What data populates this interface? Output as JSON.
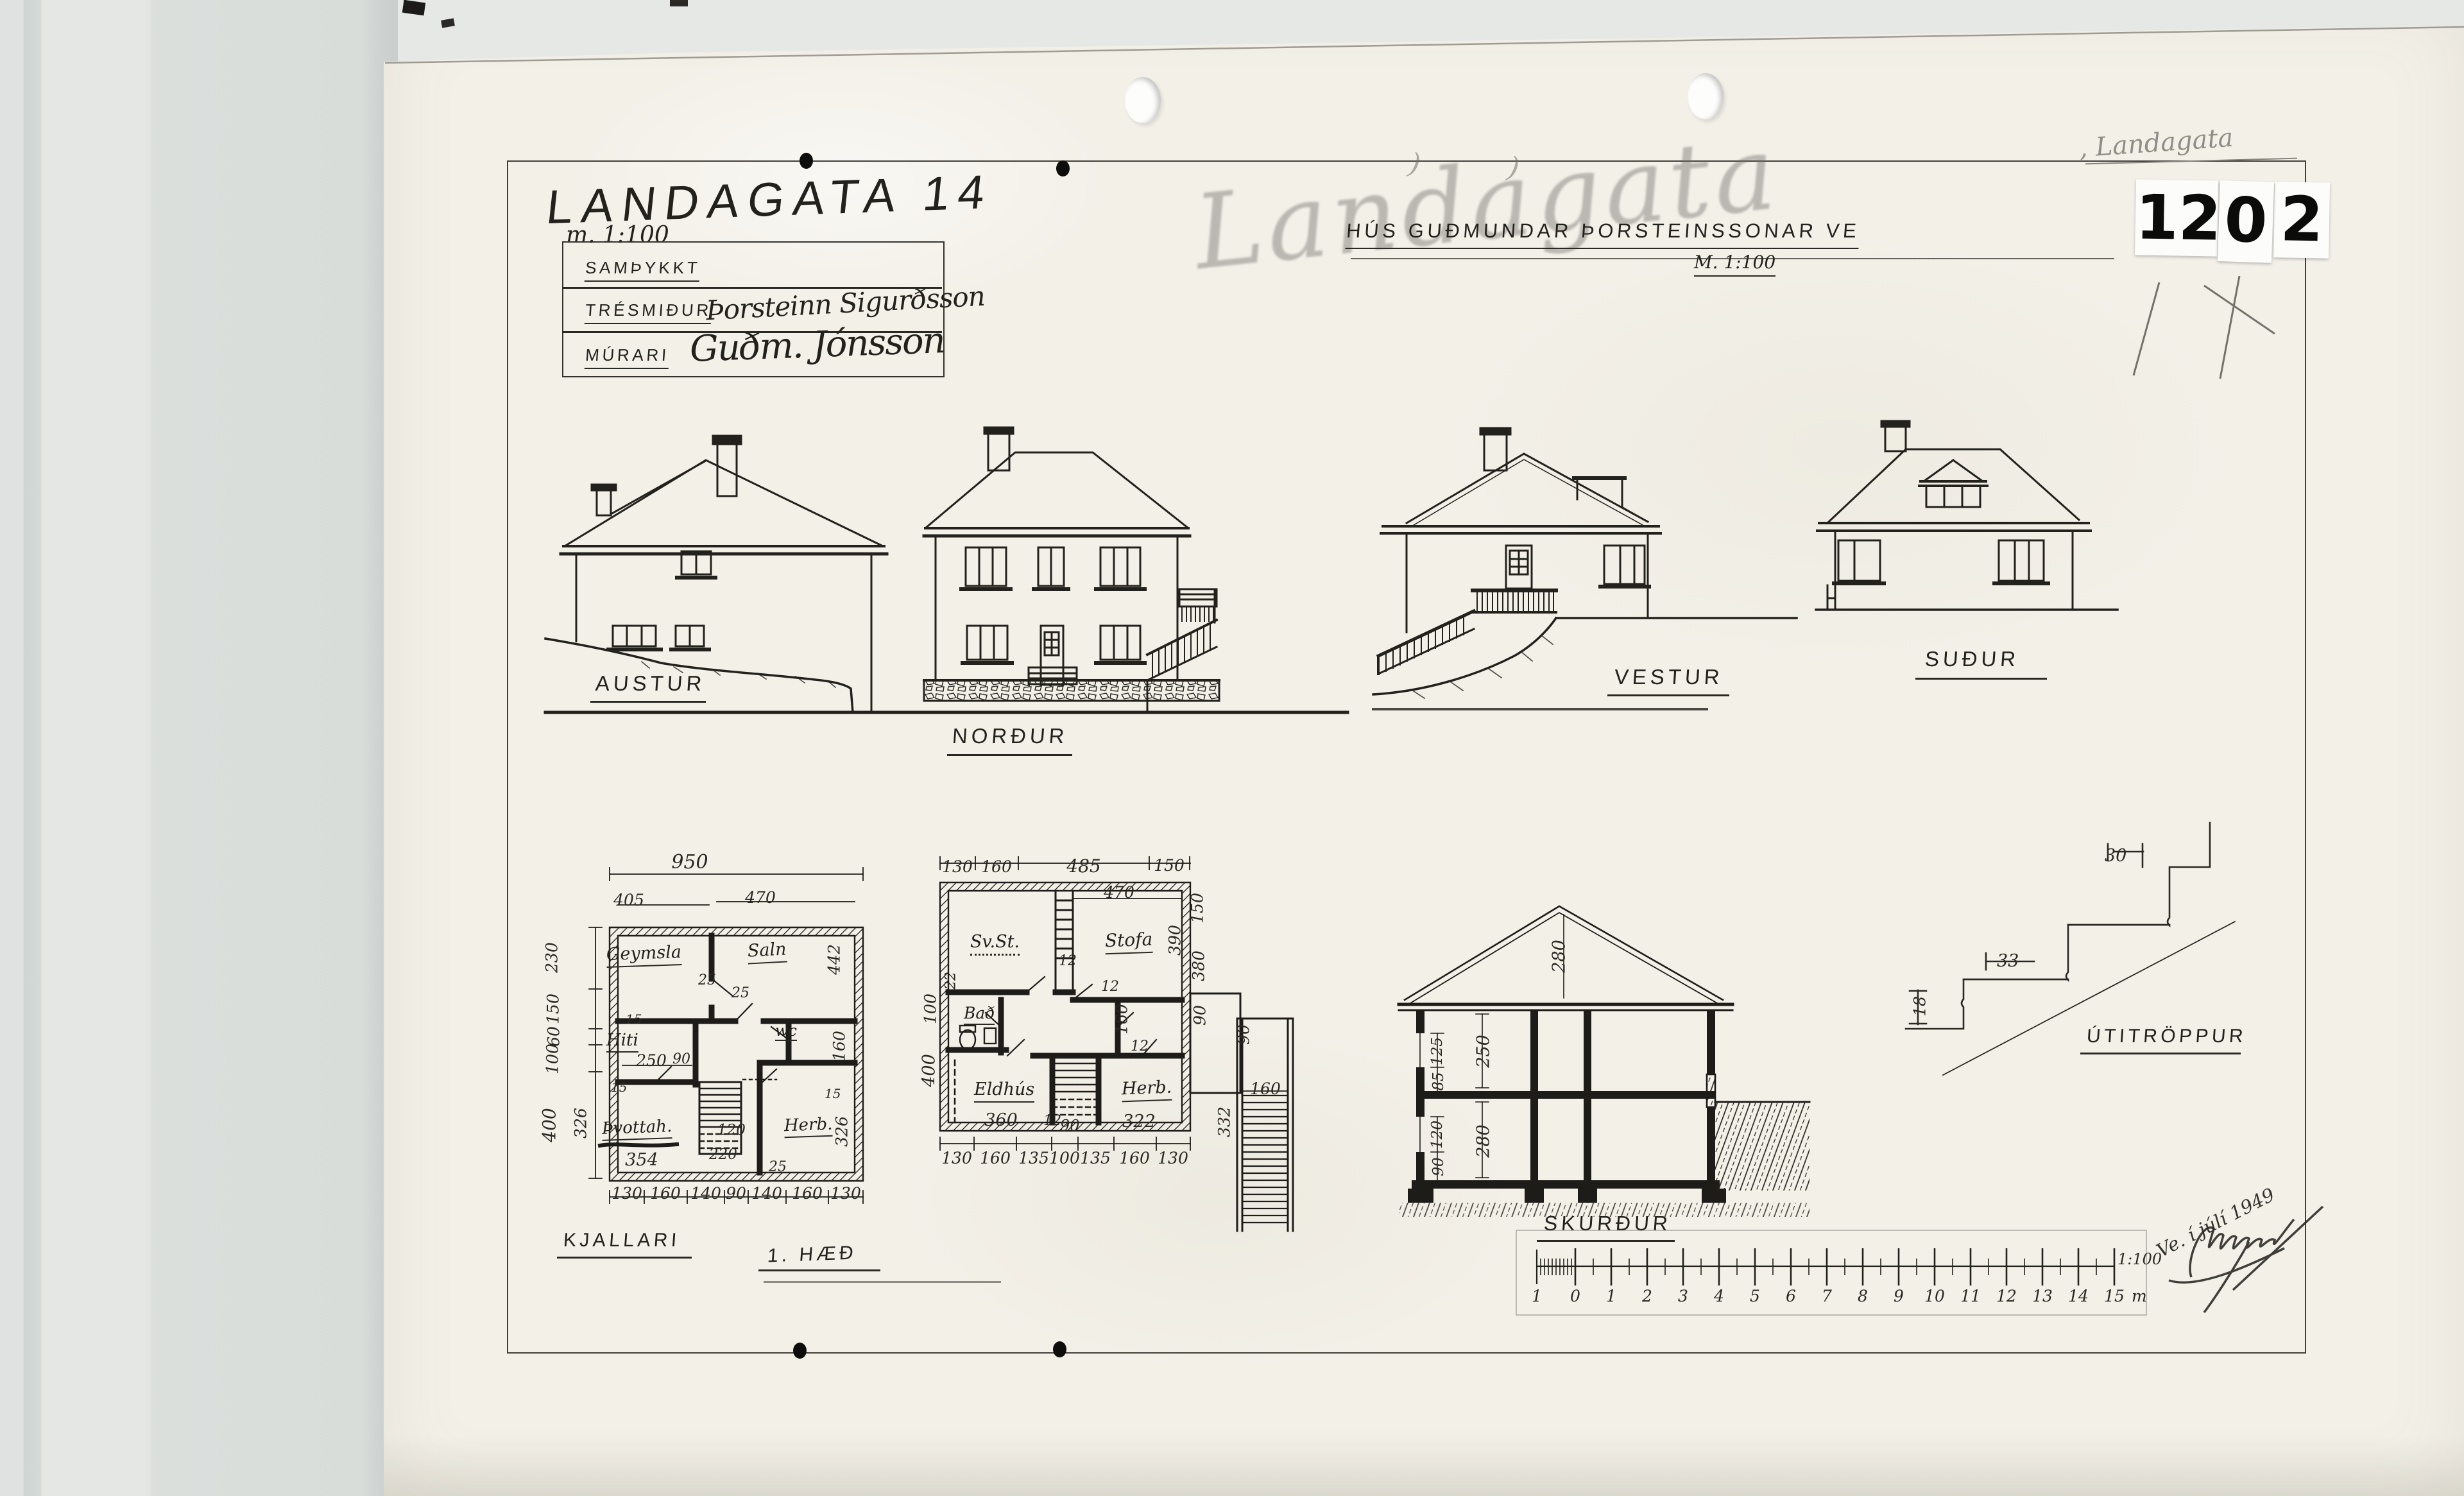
{
  "header": {
    "title": "LANDAGATA 14",
    "title_scale": "m. 1:100",
    "subtitle": "HÚS GUÐMUNDAR ÞORSTEINSSONAR VE",
    "subtitle_scale": "M. 1:100"
  },
  "pencil": {
    "large": "Landagata",
    "small": ", Landagata"
  },
  "stamp": {
    "d1": "12",
    "d2": "0",
    "d3": "2"
  },
  "approval": {
    "r1_label": "SAMÞYKKT",
    "r2_label": "TRÉSMIÐUR",
    "r2_value": "Þorsteinn Sigurðsson",
    "r3_label": "MÚRARI",
    "r3_value": "Guðm. Jónsson"
  },
  "elev": {
    "austur": "AUSTUR",
    "nordur": "NORÐUR",
    "vestur": "VESTUR",
    "sudur": "SUÐUR"
  },
  "plan1": {
    "label": "KJALLARI",
    "w950": "950",
    "w405": "405",
    "w470": "470",
    "l230": "230",
    "l150": "150",
    "l60": "60",
    "l100": "100",
    "l400": "400",
    "r442": "442",
    "r160": "160",
    "s326a": "326",
    "s326b": "326",
    "b1": "130",
    "b2": "160",
    "b3": "140",
    "b4": "90",
    "b5": "140",
    "b6": "160",
    "b7": "130",
    "room_geymsla": "Geymsla",
    "room_saln": "Saln",
    "room_hiti": "Hiti",
    "room_wc": "wc",
    "room_tvottah": "Þvottah.",
    "room_herb": "Herb.",
    "d25a": "25",
    "d25b": "25",
    "d25c": "25",
    "d15a": "15",
    "d15b": "15",
    "d15c": "15",
    "d250": "250",
    "d90": "90",
    "d120": "120",
    "d220": "220",
    "d354": "354"
  },
  "plan2": {
    "label": "1. HÆÐ",
    "t1": "130",
    "t2": "160",
    "t3": "485",
    "t4": "150",
    "w470": "470",
    "l100": "100",
    "l400": "400",
    "r150": "150",
    "r390": "390",
    "r380": "380",
    "r90": "90",
    "p90": "90",
    "p160": "160",
    "p332": "332",
    "b1": "130",
    "b2": "160",
    "b3": "135",
    "b4": "100",
    "b5": "135",
    "b6": "160",
    "b7": "130",
    "room_svst": "Sv.St.",
    "room_stofa": "Stofa",
    "room_bad": "Bað",
    "room_eldhus": "Eldhús",
    "room_herb": "Herb.",
    "d22": "22",
    "d12a": "12",
    "d12b": "12",
    "d12c": "12",
    "d12d": "12",
    "d160": "160",
    "d360": "360",
    "d90": "90",
    "d322": "322"
  },
  "section": {
    "label": "SKURÐUR",
    "d280a": "280",
    "d250": "250",
    "d280b": "280",
    "d125": "125",
    "d85": "85",
    "d120": "120",
    "d90": "90"
  },
  "stairdetail": {
    "label": "ÚTITRÖPPUR",
    "d30": "30",
    "d33": "33",
    "d18": "18"
  },
  "scalebar": {
    "labels": [
      "1",
      "0",
      "1",
      "2",
      "3",
      "4",
      "5",
      "6",
      "7",
      "8",
      "9",
      "10",
      "11",
      "12",
      "13",
      "14",
      "15"
    ],
    "unit": "m",
    "ratio": "1:100"
  },
  "signature": {
    "date": "Ve. í júlí 1949"
  }
}
